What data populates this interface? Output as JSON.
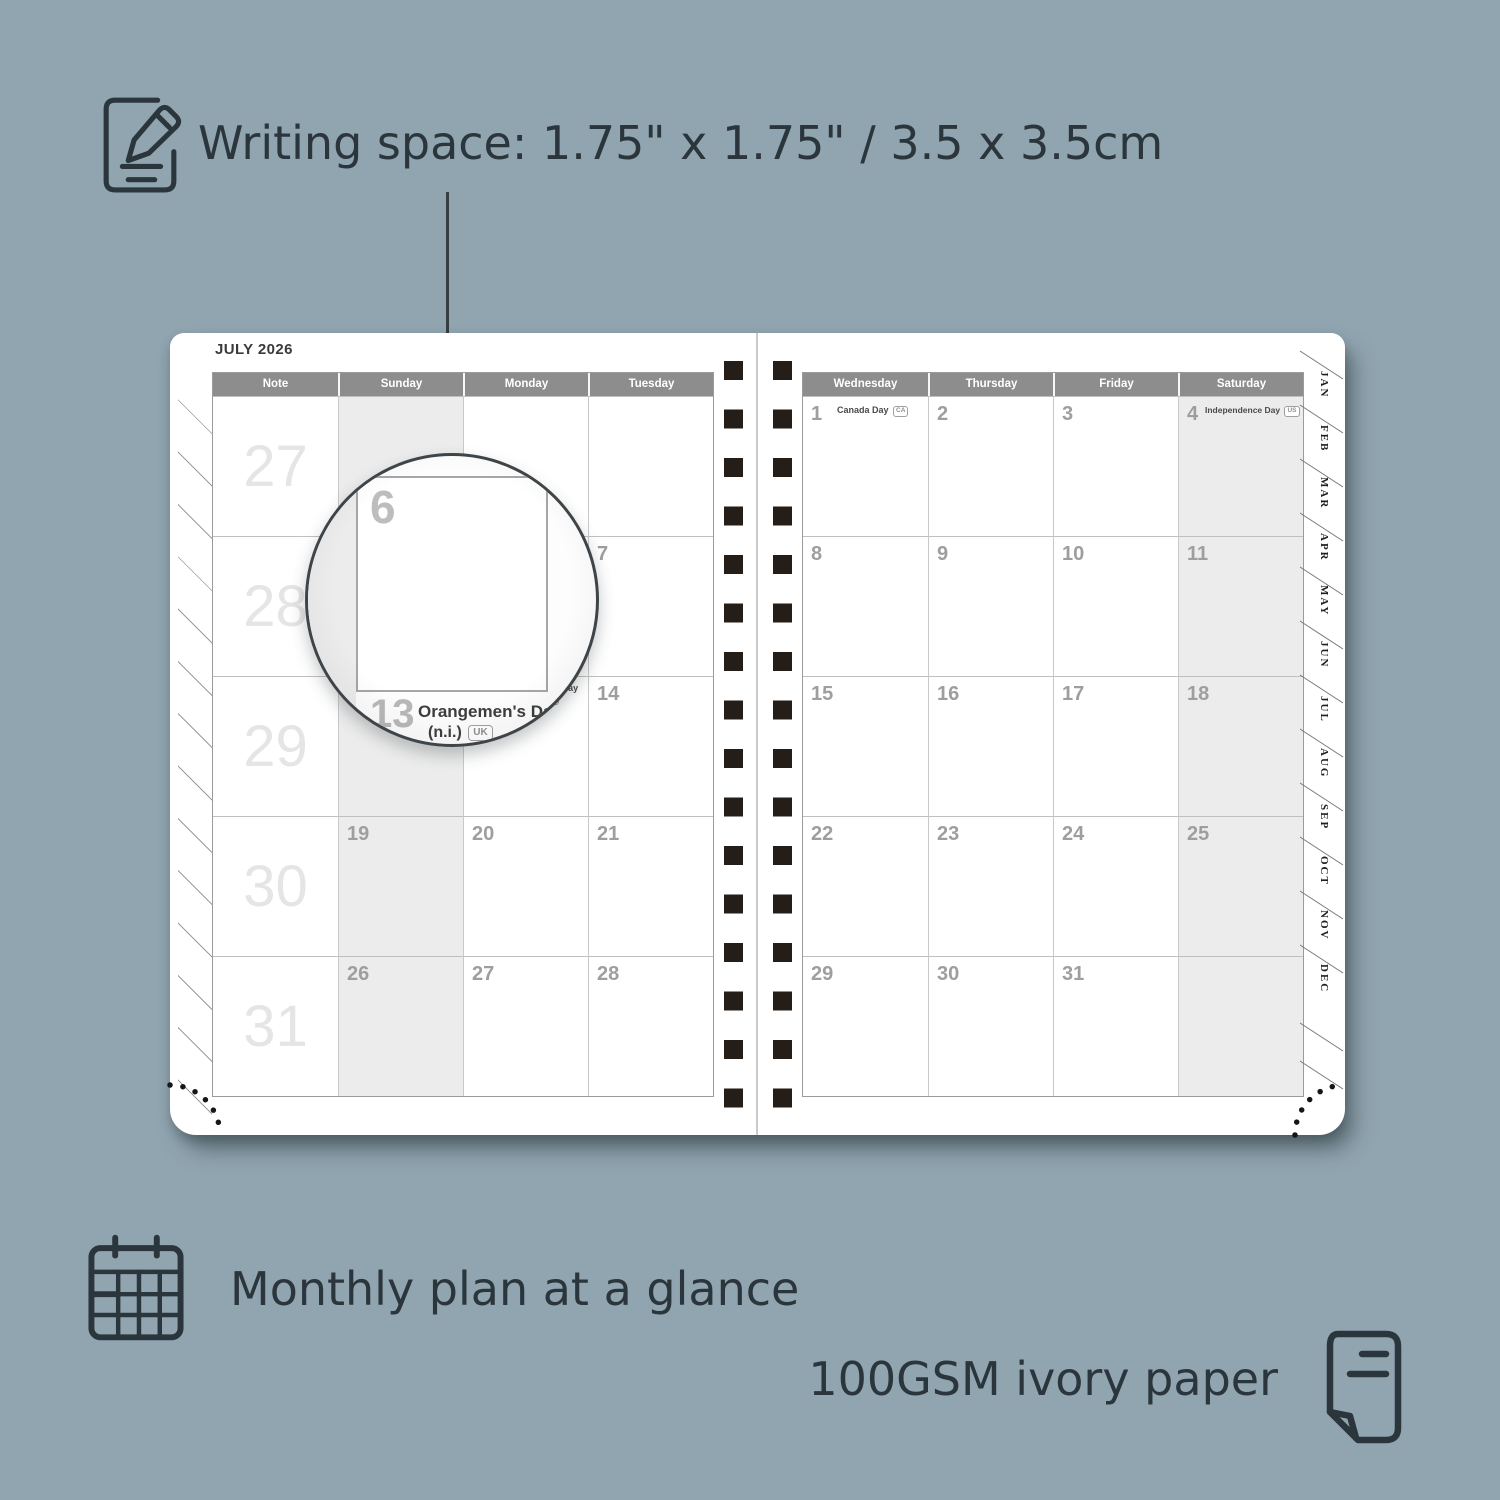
{
  "colors": {
    "background": "#91a5b1",
    "caption_text": "#2b363c",
    "header_bar": "#8d8d8d",
    "shaded_column": "#ececec",
    "date_number": "#9e9e9e",
    "week_number": "#e5e5e5",
    "spiral_hole": "#251d18"
  },
  "captions": {
    "writing_space": "Writing space: 1.75\" x 1.75\" / 3.5 x 3.5cm",
    "monthly_plan": "Monthly plan at a glance",
    "paper": "100GSM ivory paper"
  },
  "planner": {
    "month_title": "JULY 2026",
    "left_page": {
      "headers": [
        "Note",
        "Sunday",
        "Monday",
        "Tuesday"
      ],
      "week_numbers": [
        "27",
        "28",
        "29",
        "30",
        "31"
      ],
      "rows": [
        [
          "",
          "",
          ""
        ],
        [
          "5",
          "6",
          "7"
        ],
        [
          "12",
          "13",
          "14"
        ],
        [
          "19",
          "20",
          "21"
        ],
        [
          "26",
          "27",
          "28"
        ]
      ],
      "holidays": [
        {
          "row": 2,
          "col": 1,
          "name": "Orangemen's Day (n.i.)",
          "badge": "UK"
        }
      ]
    },
    "right_page": {
      "headers": [
        "Wednesday",
        "Thursday",
        "Friday",
        "Saturday"
      ],
      "rows": [
        [
          "1",
          "2",
          "3",
          "4"
        ],
        [
          "8",
          "9",
          "10",
          "11"
        ],
        [
          "15",
          "16",
          "17",
          "18"
        ],
        [
          "22",
          "23",
          "24",
          "25"
        ],
        [
          "29",
          "30",
          "31",
          ""
        ]
      ],
      "holidays": [
        {
          "row": 0,
          "col": 0,
          "name": "Canada Day",
          "badge": "CA"
        },
        {
          "row": 0,
          "col": 3,
          "name": "Independence Day",
          "badge": "US"
        }
      ]
    },
    "month_tabs": [
      "JAN",
      "FEB",
      "MAR",
      "APR",
      "MAY",
      "JUN",
      "JUL",
      "AUG",
      "SEP",
      "OCT",
      "NOV",
      "DEC"
    ]
  },
  "magnifier": {
    "day": "6",
    "partial_day": "7",
    "next_day": "13",
    "holiday_line1": "Orangemen's Day",
    "holiday_line2": "(n.i.)",
    "badge": "UK"
  }
}
